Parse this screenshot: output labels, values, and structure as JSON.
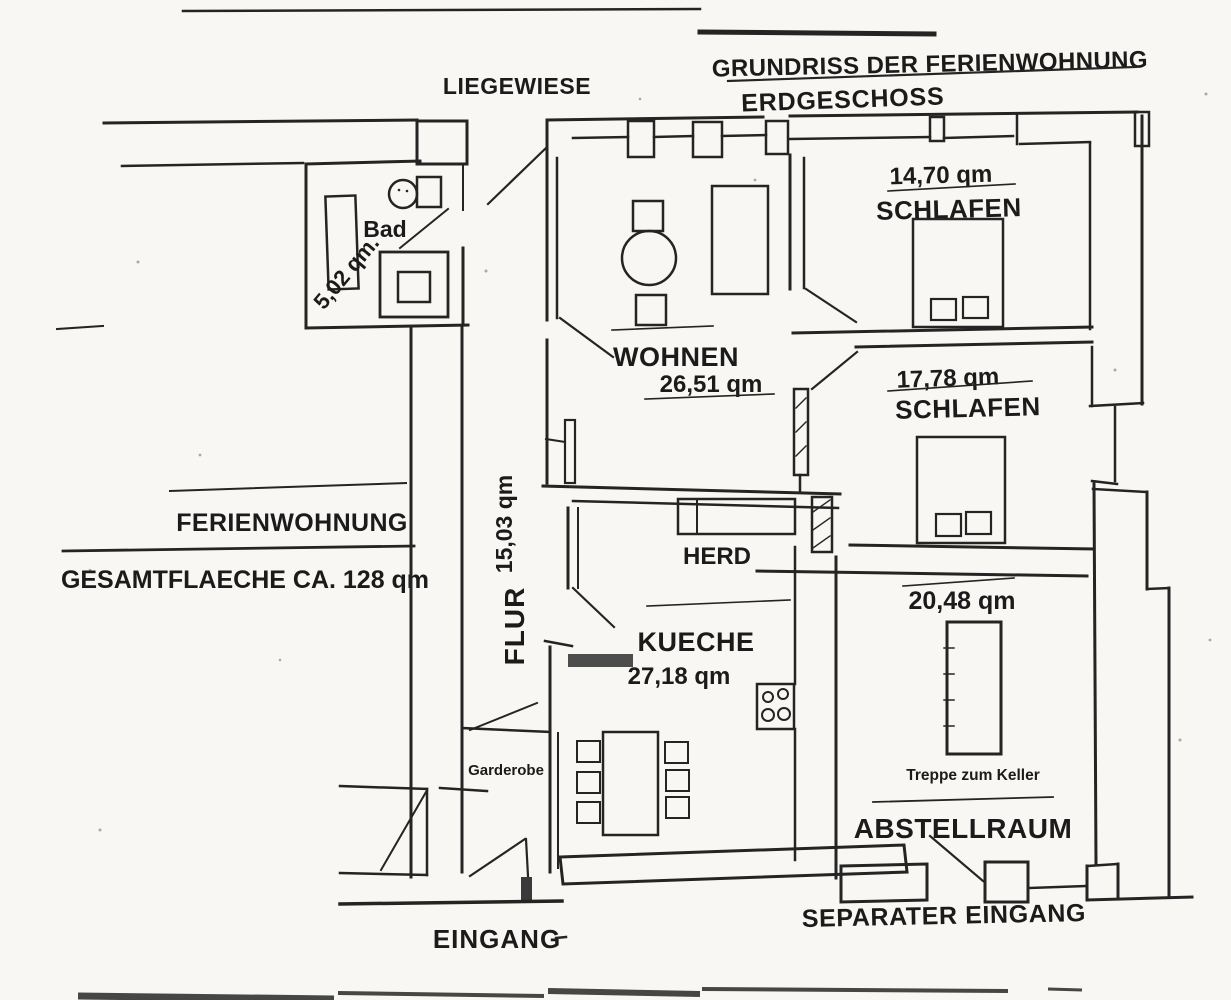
{
  "page": {
    "title": "GRUNDRISS DER FERIENWOHNUNG",
    "subtitle": "ERDGESCHOSS"
  },
  "outdoor": {
    "liegewiese": "LIEGEWIESE"
  },
  "apartment": {
    "name": "FERIENWOHNUNG",
    "total_area": "GESAMTFLAECHE CA. 128 qm"
  },
  "rooms": {
    "bad": {
      "label": "Bad",
      "area": "5,02 qm."
    },
    "wohnen": {
      "label": "WOHNEN",
      "area": "26,51 qm"
    },
    "schlafen_1": {
      "label": "SCHLAFEN",
      "area": "14,70 qm"
    },
    "schlafen_2": {
      "label": "SCHLAFEN",
      "area": "17,78 qm"
    },
    "flur": {
      "label": "FLUR",
      "area": "15,03 qm"
    },
    "kueche": {
      "label": "KUECHE",
      "area": "27,18 qm"
    },
    "abstellraum": {
      "label": "ABSTELLRAUM",
      "area": "20,48 qm"
    }
  },
  "features": {
    "herd": "HERD",
    "garderobe": "Garderobe",
    "treppe_zum_keller": "Treppe zum Keller"
  },
  "entrances": {
    "eingang": "EINGANG",
    "separater_eingang": "SEPARATER EINGANG"
  },
  "colors": {
    "ink": "#242424",
    "paper": "#f8f7f3"
  }
}
